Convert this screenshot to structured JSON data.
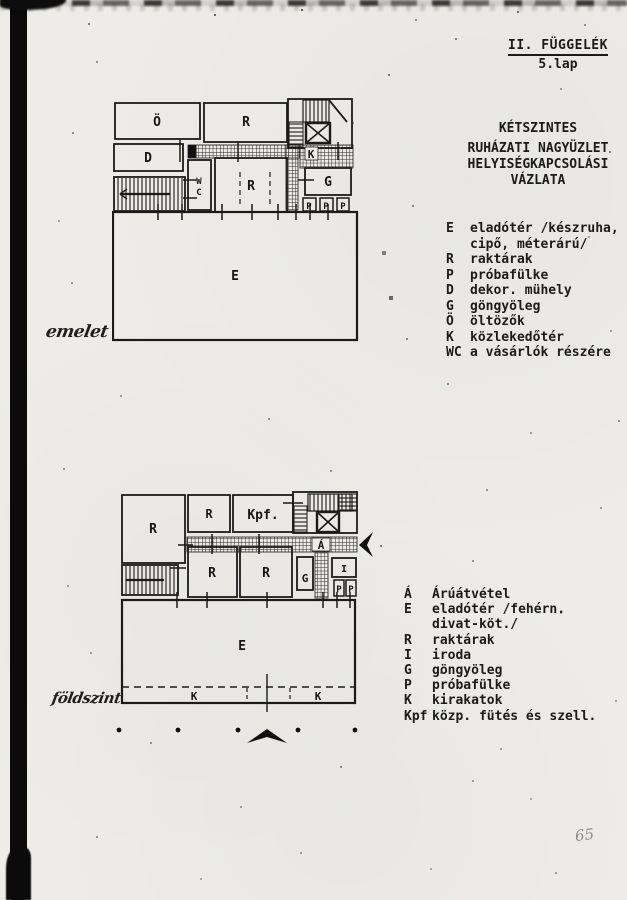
{
  "header": {
    "appendix": "II. FÜGGELÉK",
    "page": "5.lap"
  },
  "title": {
    "line1": "KÉTSZINTES",
    "line2": "RUHÁZATI NAGYÜZLET",
    "line3": "HELYISÉGKAPCSOLÁSI",
    "line4": "VÁZLATA"
  },
  "upper_plan": {
    "caption": "emelet",
    "rooms": {
      "o": "Ö",
      "r_top": "R",
      "d": "D",
      "wc_w": "W",
      "wc_c": "C",
      "r_mid": "R",
      "k": "K",
      "g": "G",
      "e": "E",
      "p1": "P",
      "p2": "P",
      "p3": "P"
    }
  },
  "upper_legend": {
    "items": [
      {
        "sym": "E",
        "text": "eladótér /készruha,\ncipő, méterárú/"
      },
      {
        "sym": "R",
        "text": "raktárak"
      },
      {
        "sym": "P",
        "text": "próbafülke"
      },
      {
        "sym": "D",
        "text": "dekor. mühely"
      },
      {
        "sym": "G",
        "text": "göngyöleg"
      },
      {
        "sym": "Ö",
        "text": "öltözők"
      },
      {
        "sym": "K",
        "text": "közlekedőtér"
      },
      {
        "sym": "WC",
        "text": "a vásárlók részére"
      }
    ]
  },
  "lower_plan": {
    "caption": "földszint",
    "rooms": {
      "r_big": "R",
      "r_top": "R",
      "kpf": "Kpf.",
      "a": "Á",
      "r1": "R",
      "r2": "R",
      "g": "G",
      "i": "I",
      "p1": "P",
      "p2": "P",
      "e": "E",
      "k_left": "K",
      "k_right": "K"
    }
  },
  "lower_legend": {
    "items": [
      {
        "sym": "Á",
        "text": "Árúátvétel"
      },
      {
        "sym": "E",
        "text": "eladótér /fehérn.\ndivat-köt./"
      },
      {
        "sym": "R",
        "text": "raktárak"
      },
      {
        "sym": "I",
        "text": "iroda"
      },
      {
        "sym": "G",
        "text": "göngyöleg"
      },
      {
        "sym": "P",
        "text": "próbafülke"
      },
      {
        "sym": "K",
        "text": "kirakatok"
      },
      {
        "sym": "Kpf",
        "text": "közp. fütés és szell."
      }
    ]
  },
  "page_number": "65",
  "colors": {
    "ink": "#1b1b1b",
    "paper": "#edece8"
  }
}
